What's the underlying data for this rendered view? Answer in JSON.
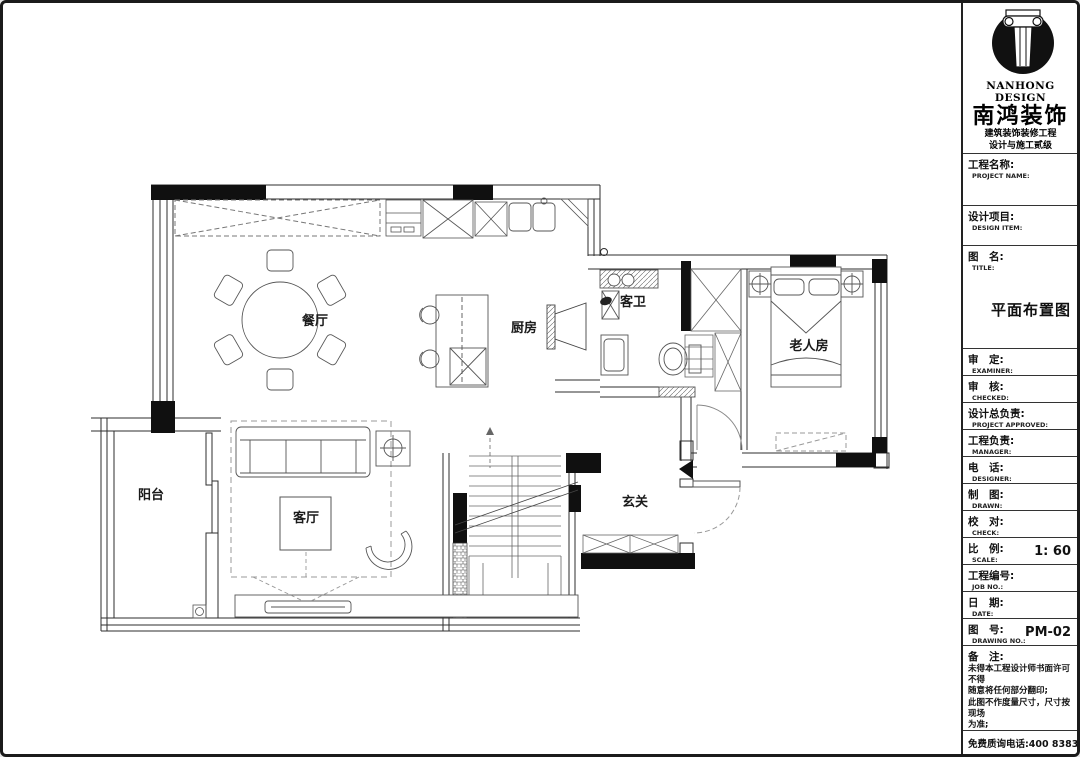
{
  "title_block": {
    "company": {
      "name_en": "NANHONG DESIGN",
      "name_cn": "南鸿装饰",
      "cert_line1": "建筑装饰装修工程",
      "cert_line2": "设计与施工贰级",
      "cert_no": "※NO: I233021396"
    },
    "fields": [
      {
        "cn": "工程名称:",
        "en": "PROJECT NAME:",
        "value": ""
      },
      {
        "cn": "设计项目:",
        "en": "DESIGN ITEM:",
        "value": ""
      },
      {
        "cn": "图　名:",
        "en": "TITLE:",
        "value": "平面布置图"
      },
      {
        "cn": "审　定:",
        "en": "EXAMINER:",
        "value": ""
      },
      {
        "cn": "审　核:",
        "en": "CHECKED:",
        "value": ""
      },
      {
        "cn": "设计总负责:",
        "en": "PROJECT APPROVED:",
        "value": ""
      },
      {
        "cn": "工程负责:",
        "en": "MANAGER:",
        "value": ""
      },
      {
        "cn": "电　话:",
        "en": "DESIGNER:",
        "value": ""
      },
      {
        "cn": "制　图:",
        "en": "DRAWN:",
        "value": ""
      },
      {
        "cn": "校　对:",
        "en": "CHECK:",
        "value": ""
      },
      {
        "cn": "比　例:",
        "en": "SCALE:",
        "value": "1: 60"
      },
      {
        "cn": "工程编号:",
        "en": "JOB NO.:",
        "value": ""
      },
      {
        "cn": "日　期:",
        "en": "DATE:",
        "value": ""
      },
      {
        "cn": "图　号:",
        "en": "DRAWING NO.:",
        "value": "PM-02"
      }
    ],
    "notes_title": "备　注:",
    "notes": [
      "未得本工程设计师书面许可不得",
      "随意将任何部分翻印;",
      "此图不作度量尺寸，尺寸按现场",
      "为准;",
      "若有不明之处，应立即通知设计",
      "师。",
      "本图纸版权归南鸿设计师所有。"
    ],
    "hotline": "免费质询电话:400 8383 168"
  },
  "floor_plan": {
    "drawing_title": "平面布置图",
    "scale": "1: 60",
    "drawing_no": "PM-02",
    "rooms": [
      {
        "id": "dining",
        "label": "餐厅"
      },
      {
        "id": "kitchen",
        "label": "厨房"
      },
      {
        "id": "guest-bath",
        "label": "客卫"
      },
      {
        "id": "elder-room",
        "label": "老人房"
      },
      {
        "id": "balcony",
        "label": "阳台"
      },
      {
        "id": "living",
        "label": "客厅"
      },
      {
        "id": "entry",
        "label": "玄关"
      }
    ]
  }
}
